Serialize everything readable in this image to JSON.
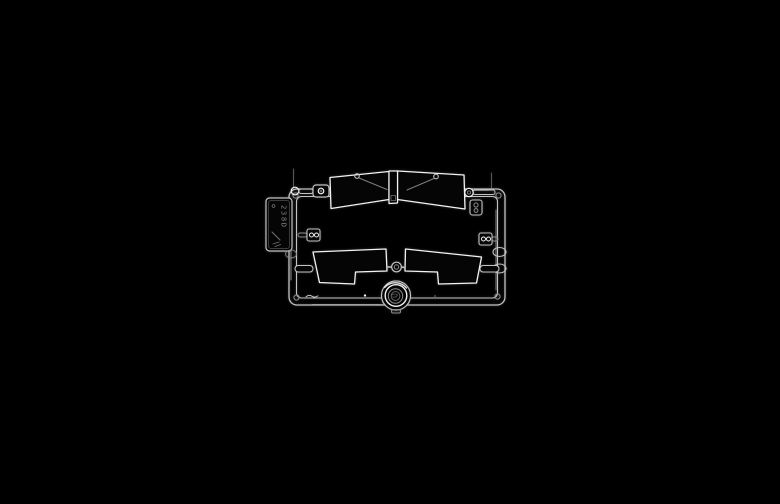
{
  "scene": {
    "type": "photograph",
    "subject": "Clear transparent plastic model kit sprue (runner of clear parts) photographed on a black background",
    "background": "pure black"
  },
  "colors": {
    "background": "#000000",
    "stroke_bright": "#f2f2f2",
    "stroke_mid": "#c2c2c2",
    "stroke_dim": "#8c8c8c",
    "part_fill": "#050505"
  },
  "sprue": {
    "tag_embossed_text": "238D",
    "parts": [
      {
        "id": "runner-frame",
        "label": "rectangular runner frame with rounded corners"
      },
      {
        "id": "molded-tag",
        "label": "molded identification tag with embossed markings"
      },
      {
        "id": "windshield",
        "label": "two-pane windshield with center divider"
      },
      {
        "id": "clip-left",
        "label": "small clip with round hole (top left)"
      },
      {
        "id": "bracket-right",
        "label": "small bracket with round holes (top right)"
      },
      {
        "id": "side-window-left",
        "label": "left stepped side window"
      },
      {
        "id": "side-window-right",
        "label": "right stepped side window"
      },
      {
        "id": "grommet",
        "label": "small round grommet between windows"
      },
      {
        "id": "lens",
        "label": "round headlamp lens on bottom rail"
      },
      {
        "id": "small-clips",
        "label": "small twin-hole clips on side rails"
      }
    ]
  }
}
